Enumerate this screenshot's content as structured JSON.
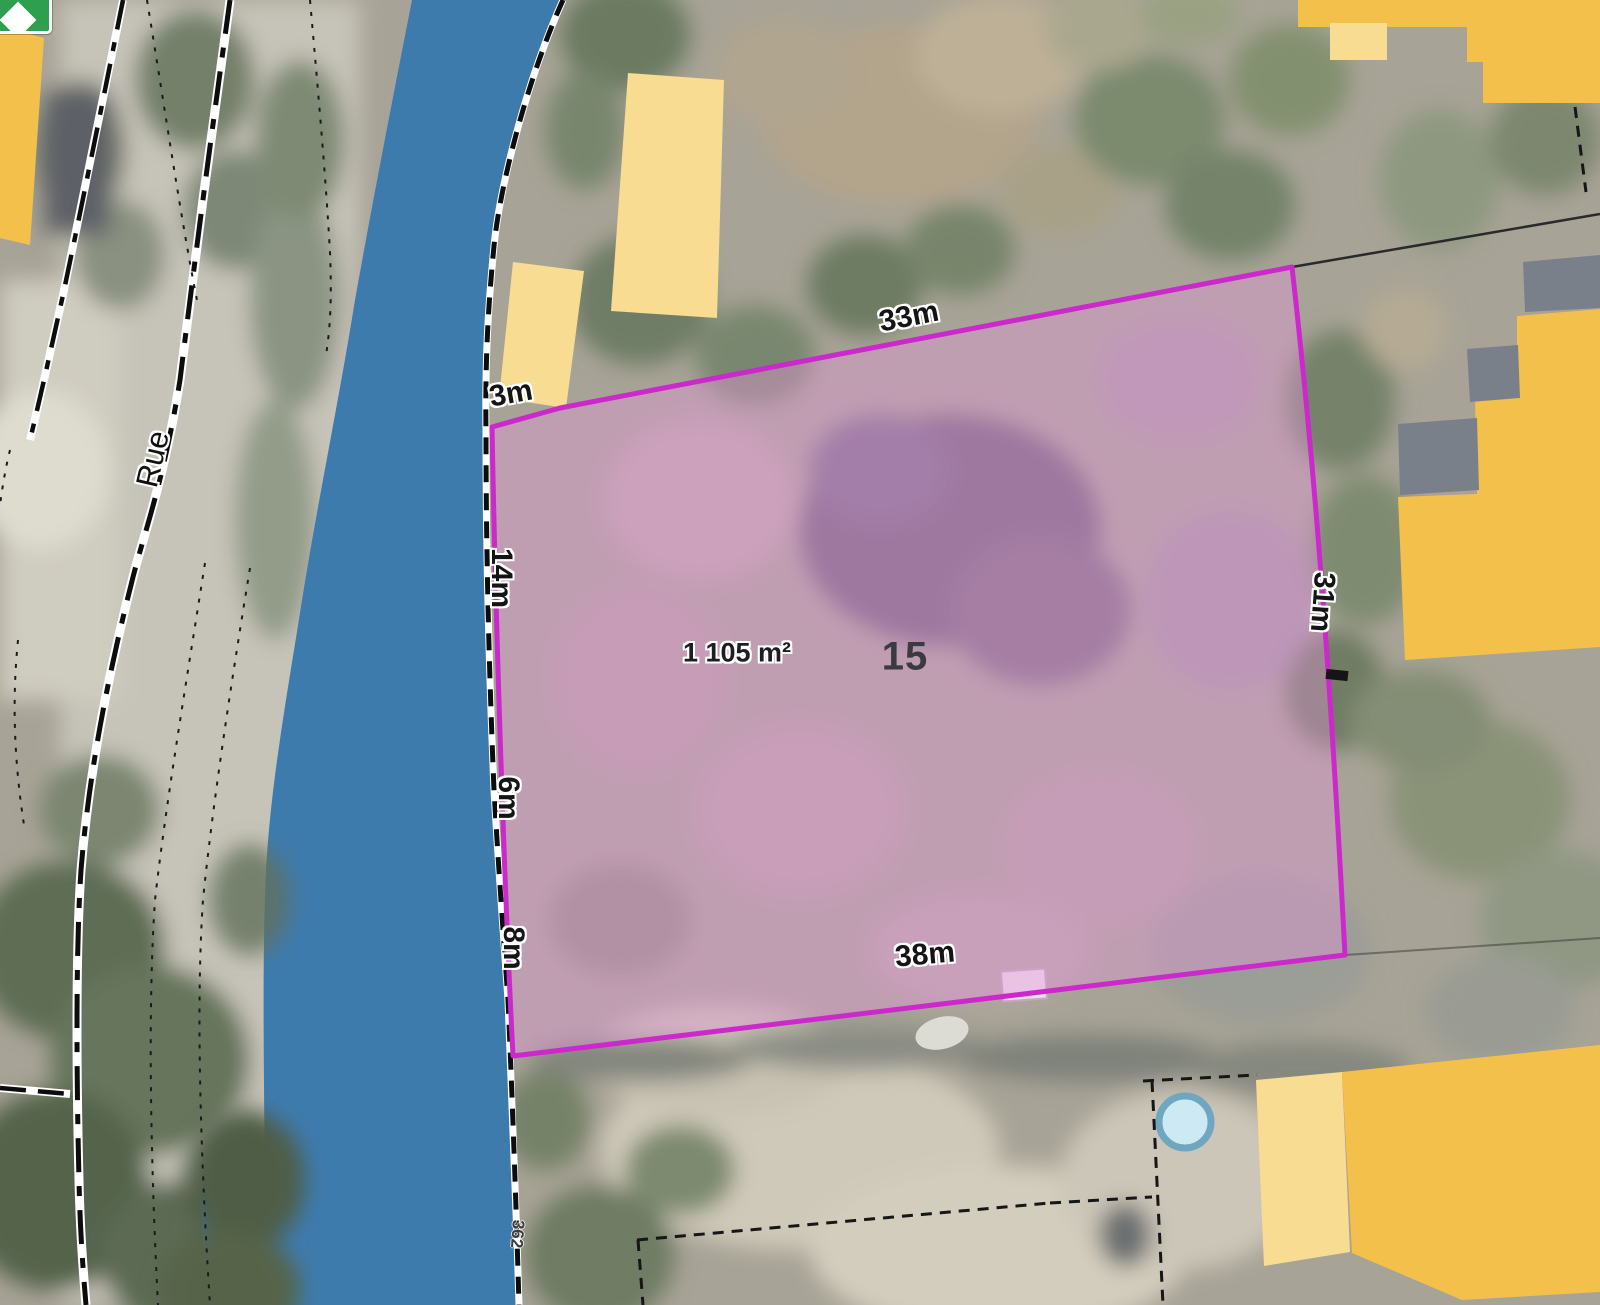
{
  "map": {
    "selected_parcel": {
      "number": "15",
      "area_label": "1 105 m²",
      "edge_labels": {
        "top_short": "3m",
        "top": "33m",
        "right": "31m",
        "bottom": "38m",
        "left_upper": "14m",
        "left_middle": "6m",
        "left_lower": "8m"
      }
    },
    "street_label": "Rue",
    "neighbour_parcel_ref": "362",
    "colors": {
      "parcel_outline": "#cb29cb",
      "parcel_fill": "rgba(233,150,223,0.38)",
      "water": "#3e7bad",
      "building_light_yellow": "#f8dc92",
      "building_dark_yellow": "#f3c14b",
      "roof_gray": "#7a8089",
      "pool_water": "#cdeaf4",
      "poi_icon_green": "#2e9e4f"
    }
  }
}
